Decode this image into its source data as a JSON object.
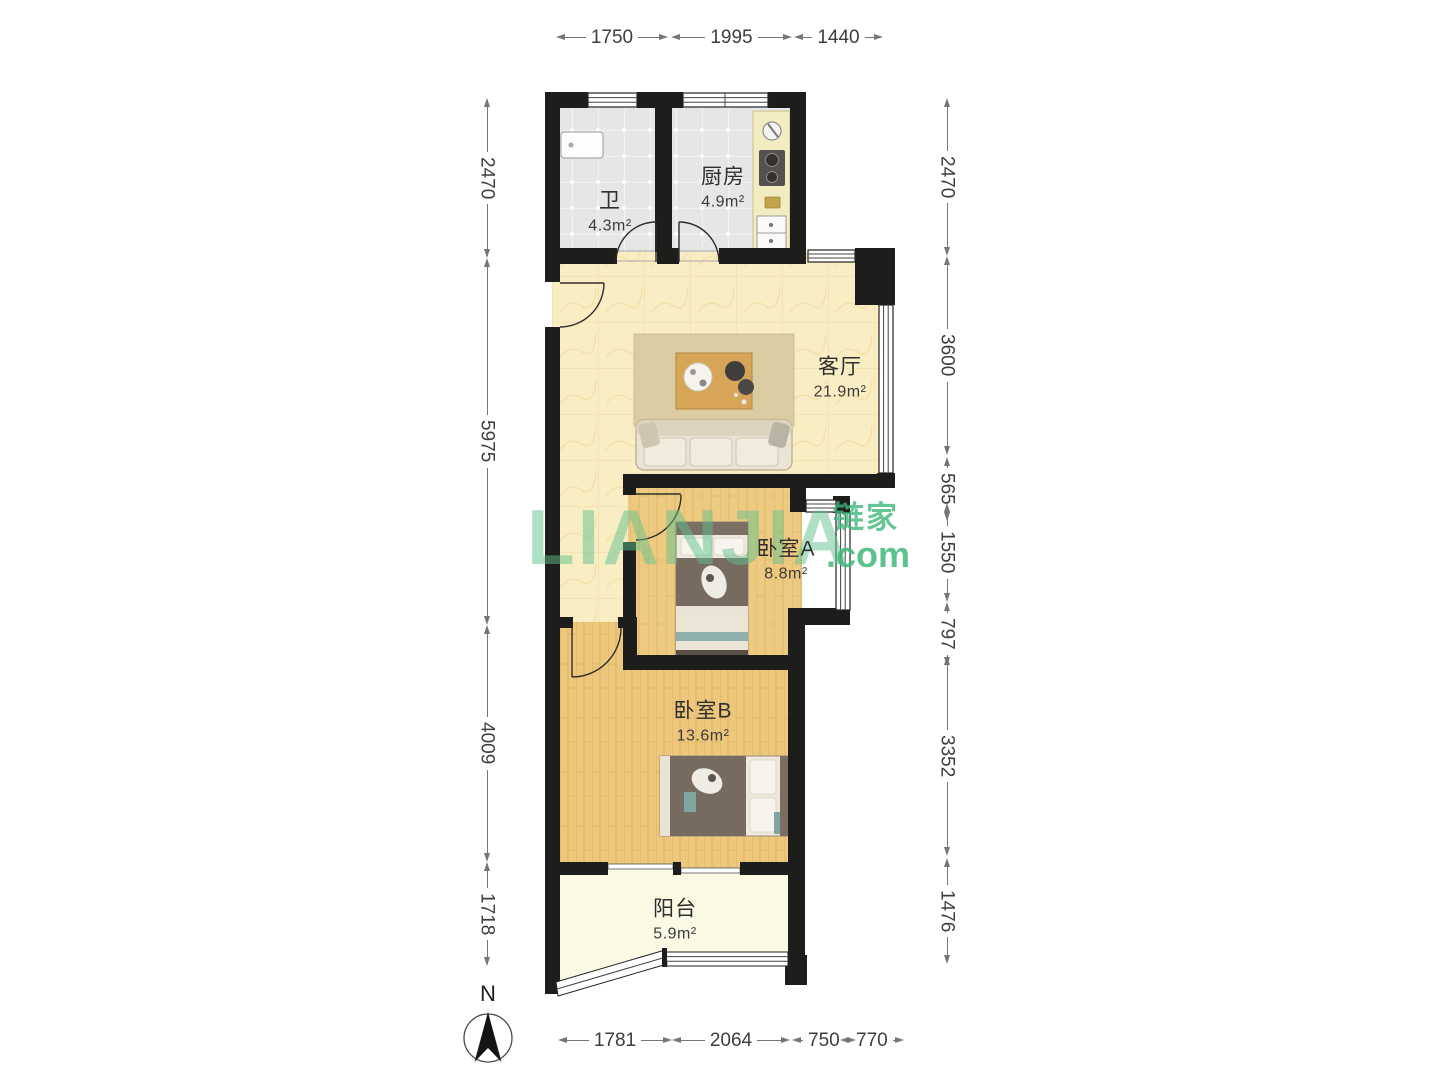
{
  "watermark": {
    "brand": "LIANJIA",
    "brand_cn": "链家",
    "brand_suffix": ".com",
    "color": "#52bd8b"
  },
  "compass": {
    "label": "N"
  },
  "rooms": [
    {
      "id": "bathroom",
      "name": "卫",
      "area": "4.3m²"
    },
    {
      "id": "kitchen",
      "name": "厨房",
      "area": "4.9m²"
    },
    {
      "id": "living-room",
      "name": "客厅",
      "area": "21.9m²"
    },
    {
      "id": "bedroom-a",
      "name": "卧室A",
      "area": "8.8m²"
    },
    {
      "id": "bedroom-b",
      "name": "卧室B",
      "area": "13.6m²"
    },
    {
      "id": "balcony",
      "name": "阳台",
      "area": "5.9m²"
    }
  ],
  "dimensions": {
    "top": [
      "1750",
      "1995",
      "1440"
    ],
    "left": [
      "2470",
      "5975",
      "4009",
      "1718"
    ],
    "right": [
      "2470",
      "3600",
      "565",
      "1550",
      "797",
      "3352",
      "1476"
    ],
    "bottom": [
      "1781",
      "2064",
      "750",
      "770"
    ]
  },
  "plan_colors": {
    "wall": "#1d1d1b",
    "tile_floor": "#e6e6e4",
    "marble_floor": "#f9edc4",
    "wood_floor": "#eeca80",
    "balcony_floor": "#fbf8e4",
    "watermark_green": "#52bd8b"
  }
}
